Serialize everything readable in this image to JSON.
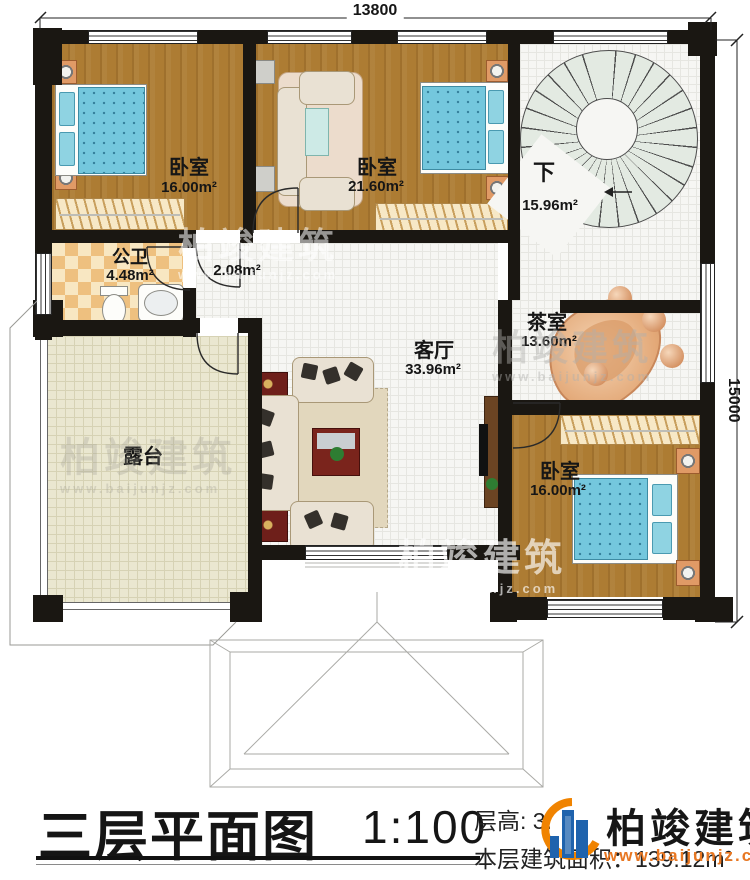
{
  "plan": {
    "dimensions": {
      "top": "13800",
      "right": "15000"
    },
    "rooms": [
      {
        "name": "卧室",
        "area": "16.00m²"
      },
      {
        "name": "卧室",
        "area": "21.60m²"
      },
      {
        "name": "下",
        "area": "15.96m²"
      },
      {
        "name": "公卫",
        "area": "4.48m²"
      },
      {
        "name": "",
        "area": "2.08m²"
      },
      {
        "name": "客厅",
        "area": "33.96m²"
      },
      {
        "name": "茶室",
        "area": "13.60m²"
      },
      {
        "name": "露台",
        "area": ""
      },
      {
        "name": "卧室",
        "area": "16.00m²"
      }
    ]
  },
  "watermark": {
    "brand": "柏竣建筑",
    "website": "www.baijunjz.com"
  },
  "footer": {
    "title": "三层平面图",
    "scale": "1:100",
    "floor_height": "层高: 3.",
    "building_area": "本层建筑面积：139.12m²",
    "brand": "柏竣建筑",
    "website": "www.baijunjz.com"
  },
  "colors": {
    "wall": "#1a1712",
    "wood": "#ad7c33",
    "tile": "#f6f6f3",
    "terrace": "#eae7d0",
    "accent_orange": "#e87722",
    "brand_blue": "#1f63ad",
    "mattress_blue": "#74c7dd"
  }
}
